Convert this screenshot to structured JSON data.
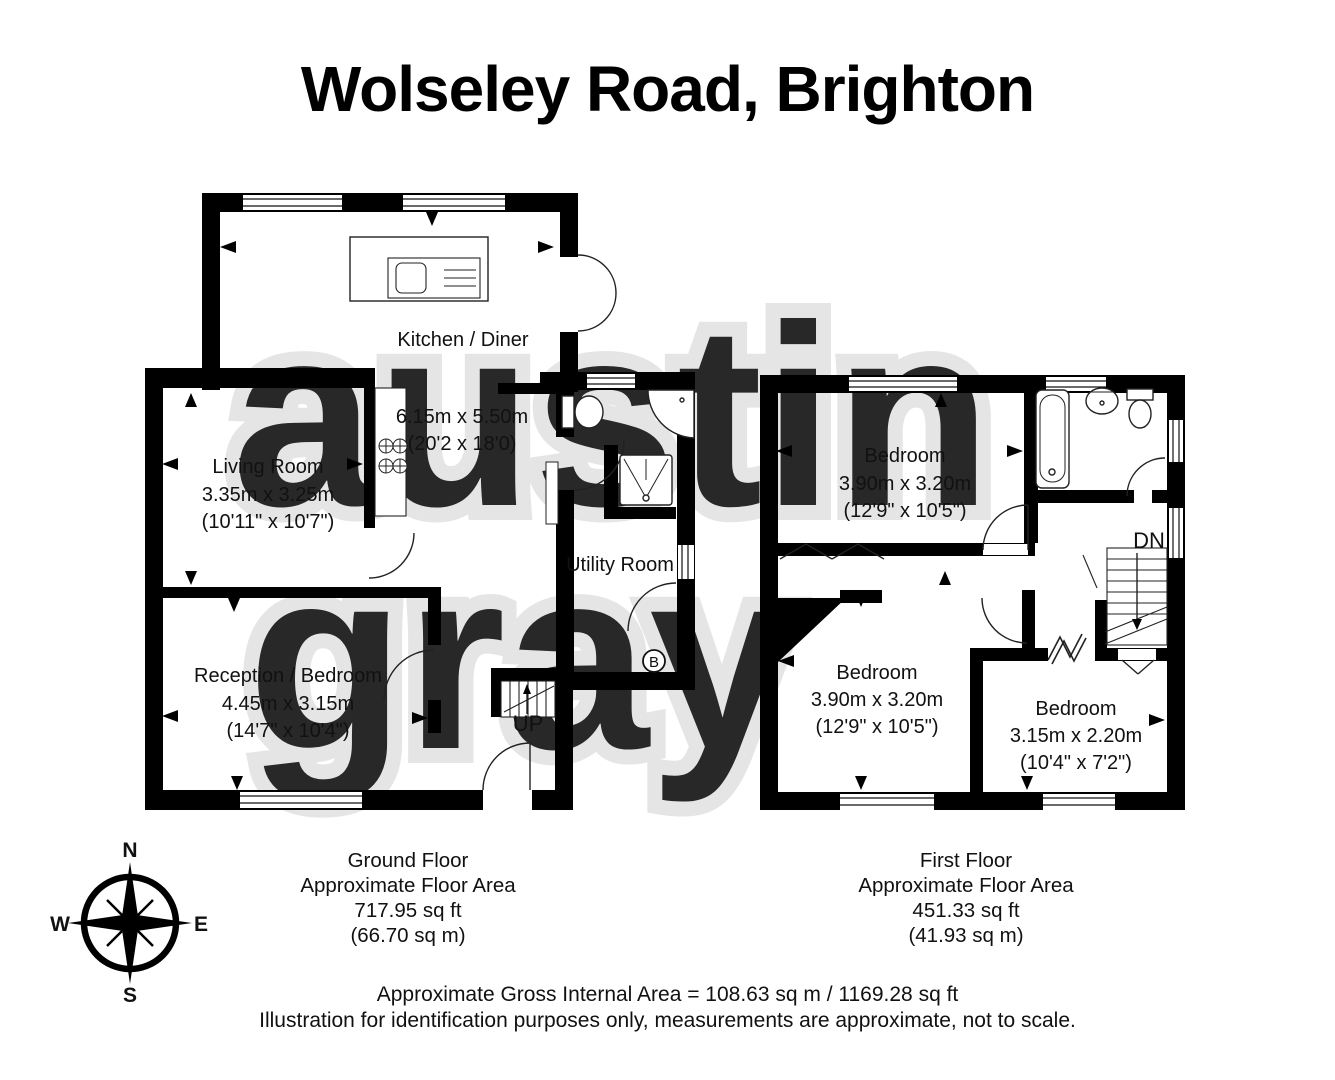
{
  "title": "Wolseley Road, Brighton",
  "watermark": {
    "line1": "austin",
    "line2": "gray"
  },
  "ground_floor": {
    "kitchen": {
      "name": "Kitchen / Diner",
      "metric": "6.15m x 5.50m",
      "imperial": "(20'2 x 18'0)"
    },
    "living": {
      "name": "Living Room",
      "metric": "3.35m x 3.25m",
      "imperial": "(10'11\" x 10'7\")"
    },
    "reception": {
      "name": "Reception / Bedroom",
      "metric": "4.45m x 3.15m",
      "imperial": "(14'7\" x 10'4\")"
    },
    "utility": {
      "name": "Utility Room"
    },
    "stairs_label": "UP",
    "boiler_label": "B",
    "area": {
      "floor": "Ground Floor",
      "caption": "Approximate Floor Area",
      "sqft": "717.95 sq ft",
      "sqm": "(66.70 sq m)"
    }
  },
  "first_floor": {
    "bedroom1": {
      "name": "Bedroom",
      "metric": "3.90m x 3.20m",
      "imperial": "(12'9\" x 10'5\")"
    },
    "bedroom2": {
      "name": "Bedroom",
      "metric": "3.90m x 3.20m",
      "imperial": "(12'9\" x 10'5\")"
    },
    "bedroom3": {
      "name": "Bedroom",
      "metric": "3.15m x 2.20m",
      "imperial": "(10'4\" x 7'2\")"
    },
    "stairs_label": "DN",
    "area": {
      "floor": "First Floor",
      "caption": "Approximate Floor Area",
      "sqft": "451.33 sq ft",
      "sqm": "(41.93 sq m)"
    }
  },
  "compass": {
    "n": "N",
    "e": "E",
    "s": "S",
    "w": "W"
  },
  "footer": {
    "line1": "Approximate Gross Internal Area = 108.63 sq m / 1169.28 sq ft",
    "line2": "Illustration for identification purposes only, measurements are approximate, not to scale."
  }
}
